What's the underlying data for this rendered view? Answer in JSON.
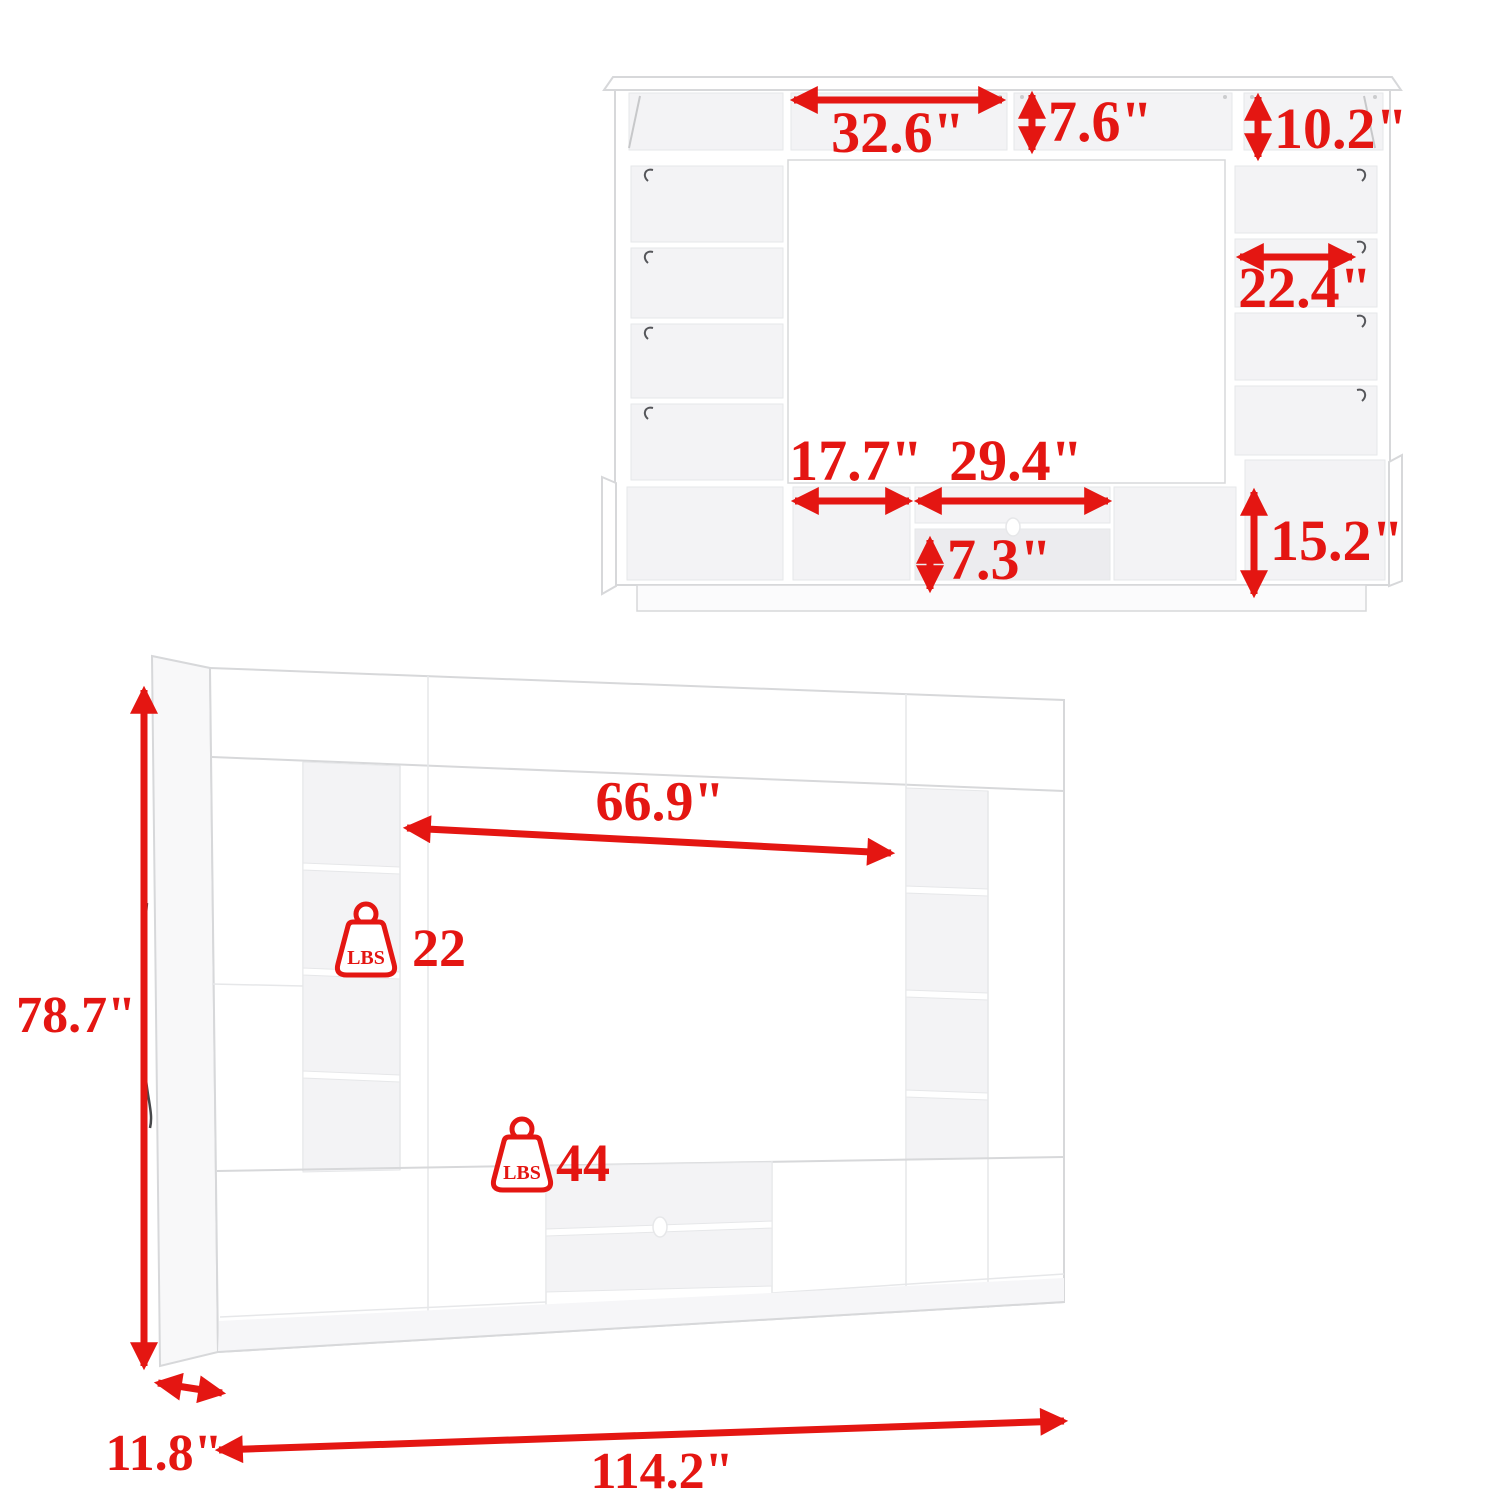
{
  "colors": {
    "accent": "#e41612",
    "line": "#d7d8da",
    "softline": "#e6e7e9",
    "interior": "#f3f3f5",
    "interior2": "#ececef",
    "side": "#f8f8f9"
  },
  "front_view": {
    "dims": {
      "bridge_width": "32.6\"",
      "bridge_height": "7.6\"",
      "top_cabinet_height": "10.2\"",
      "side_shelf_width": "22.4\"",
      "left_console_cubby_width": "17.7\"",
      "tv_console_width": "29.4\"",
      "tv_console_shelf_height": "7.3\"",
      "bottom_cabinet_height": "15.2\""
    }
  },
  "perspective_view": {
    "dims": {
      "tv_opening_width": "66.9\"",
      "overall_height": "78.7\"",
      "overall_width": "114.2\"",
      "depth": "11.8\""
    },
    "weight_capacity": {
      "unit_label": "LBS",
      "shelf_lbs": "22",
      "tv_board_lbs": "44"
    }
  }
}
